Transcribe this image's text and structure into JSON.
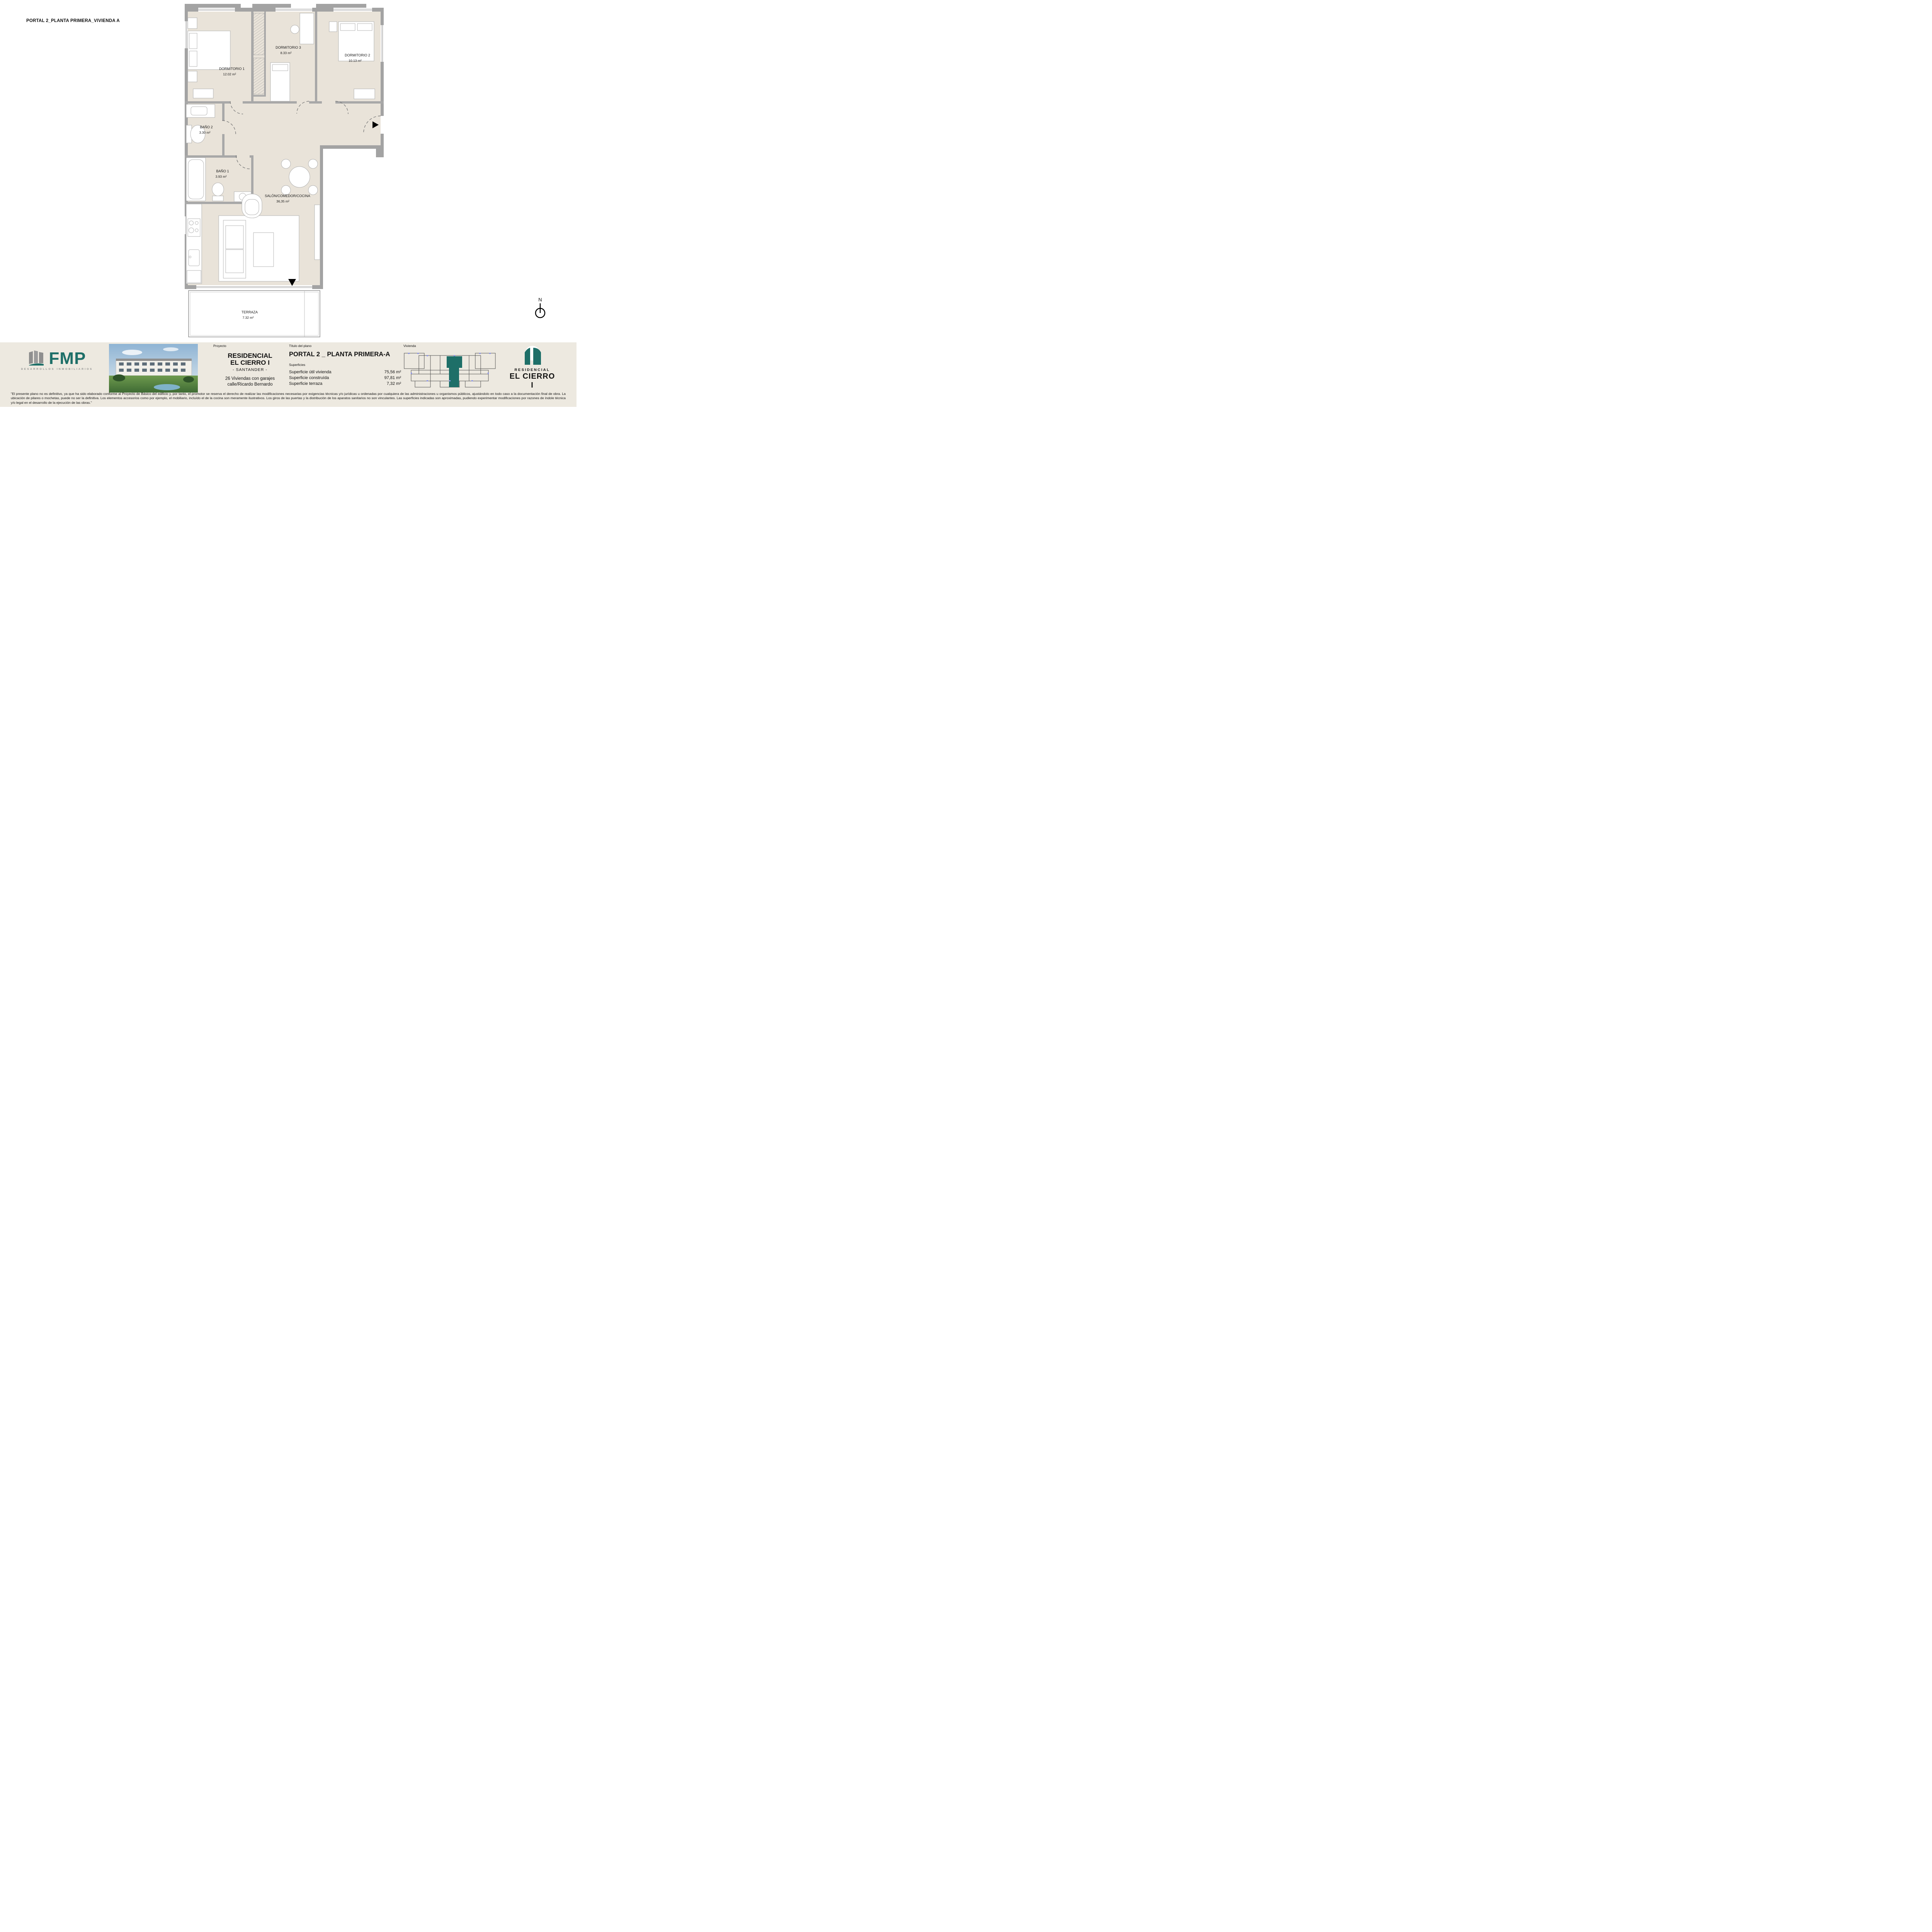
{
  "page": {
    "title": "PORTAL 2_PLANTA PRIMERA_VIVIENDA A"
  },
  "plan": {
    "north_label": "N",
    "rooms": [
      {
        "name": "DORMITORIO 1",
        "area": "12.02 m²"
      },
      {
        "name": "DORMITORIO 3",
        "area": "8.33 m²"
      },
      {
        "name": "DORMITORIO 2",
        "area": "10.13 m²"
      },
      {
        "name": "BAÑO 2",
        "area": "3.30 m²"
      },
      {
        "name": "BAÑO 1",
        "area": "3.93 m²"
      },
      {
        "name": "SALÓN/COMEDOR/COCINA",
        "area": "36,35 m²"
      },
      {
        "name": "TERRAZA",
        "area": "7.32 m²"
      }
    ]
  },
  "footer": {
    "fmp": {
      "name": "FMP",
      "tagline": "DESARROLLOS INMOBILIARIOS"
    },
    "proyecto": {
      "label": "Proyecto",
      "title_line1": "RESIDENCIAL",
      "title_line2": "EL CIERRO I",
      "subtitle": "- SANTANDER -",
      "description_line1": "26 Viviendas con garajes",
      "description_line2": "calle/Ricardo Bernardo"
    },
    "titulo": {
      "label": "Título del plano",
      "title": "PORTAL 2 _ PLANTA PRIMERA-A",
      "superficies_label": "Superficies",
      "rows": [
        {
          "label": "Superficie útil vivienda",
          "value": "75,56 m²"
        },
        {
          "label": "Superficie construída",
          "value": "97,81 m²"
        },
        {
          "label": "Superficie terraza",
          "value": "7,32 m²"
        }
      ]
    },
    "vivienda": {
      "label": "Vivienda"
    },
    "brand": {
      "line1": "RESIDENCIAL",
      "line2": "EL CIERRO I"
    }
  },
  "colors": {
    "teal": "#1E6F68",
    "wall_gray": "#A3A3A3",
    "floor_beige": "#E9E3D9",
    "footer_beige": "#EDE9E0"
  },
  "disclaimer": "\"El presente plano no es definitivo, ya que ha sido elaborado conforme al Proyecto de Básico del edificio y, por tanto, el promotor se reserva el derecho de realizar las modificaciones necesarias por exigencias técnicas y/o jurídicas u ordenadas por cualquiera de las administraciones u organismos públicos, ajustándolo en todo caso a la documentación final de obra. La ubicación de pilares o mochetas, puede no ser la definitiva. Los elementos accesorios como por ejemplo, el mobiliario, incluído el de la cocina son meramente ilustrativos. Los giros de las puertas y la distribución de los aparatos sanitarios no son vinculantes. Las superficies indicadas son aproximadas, pudiendo experimentar modificaciones por razones de índole técnica y/o legal en el desarrollo de la ejecución de las obras.\""
}
